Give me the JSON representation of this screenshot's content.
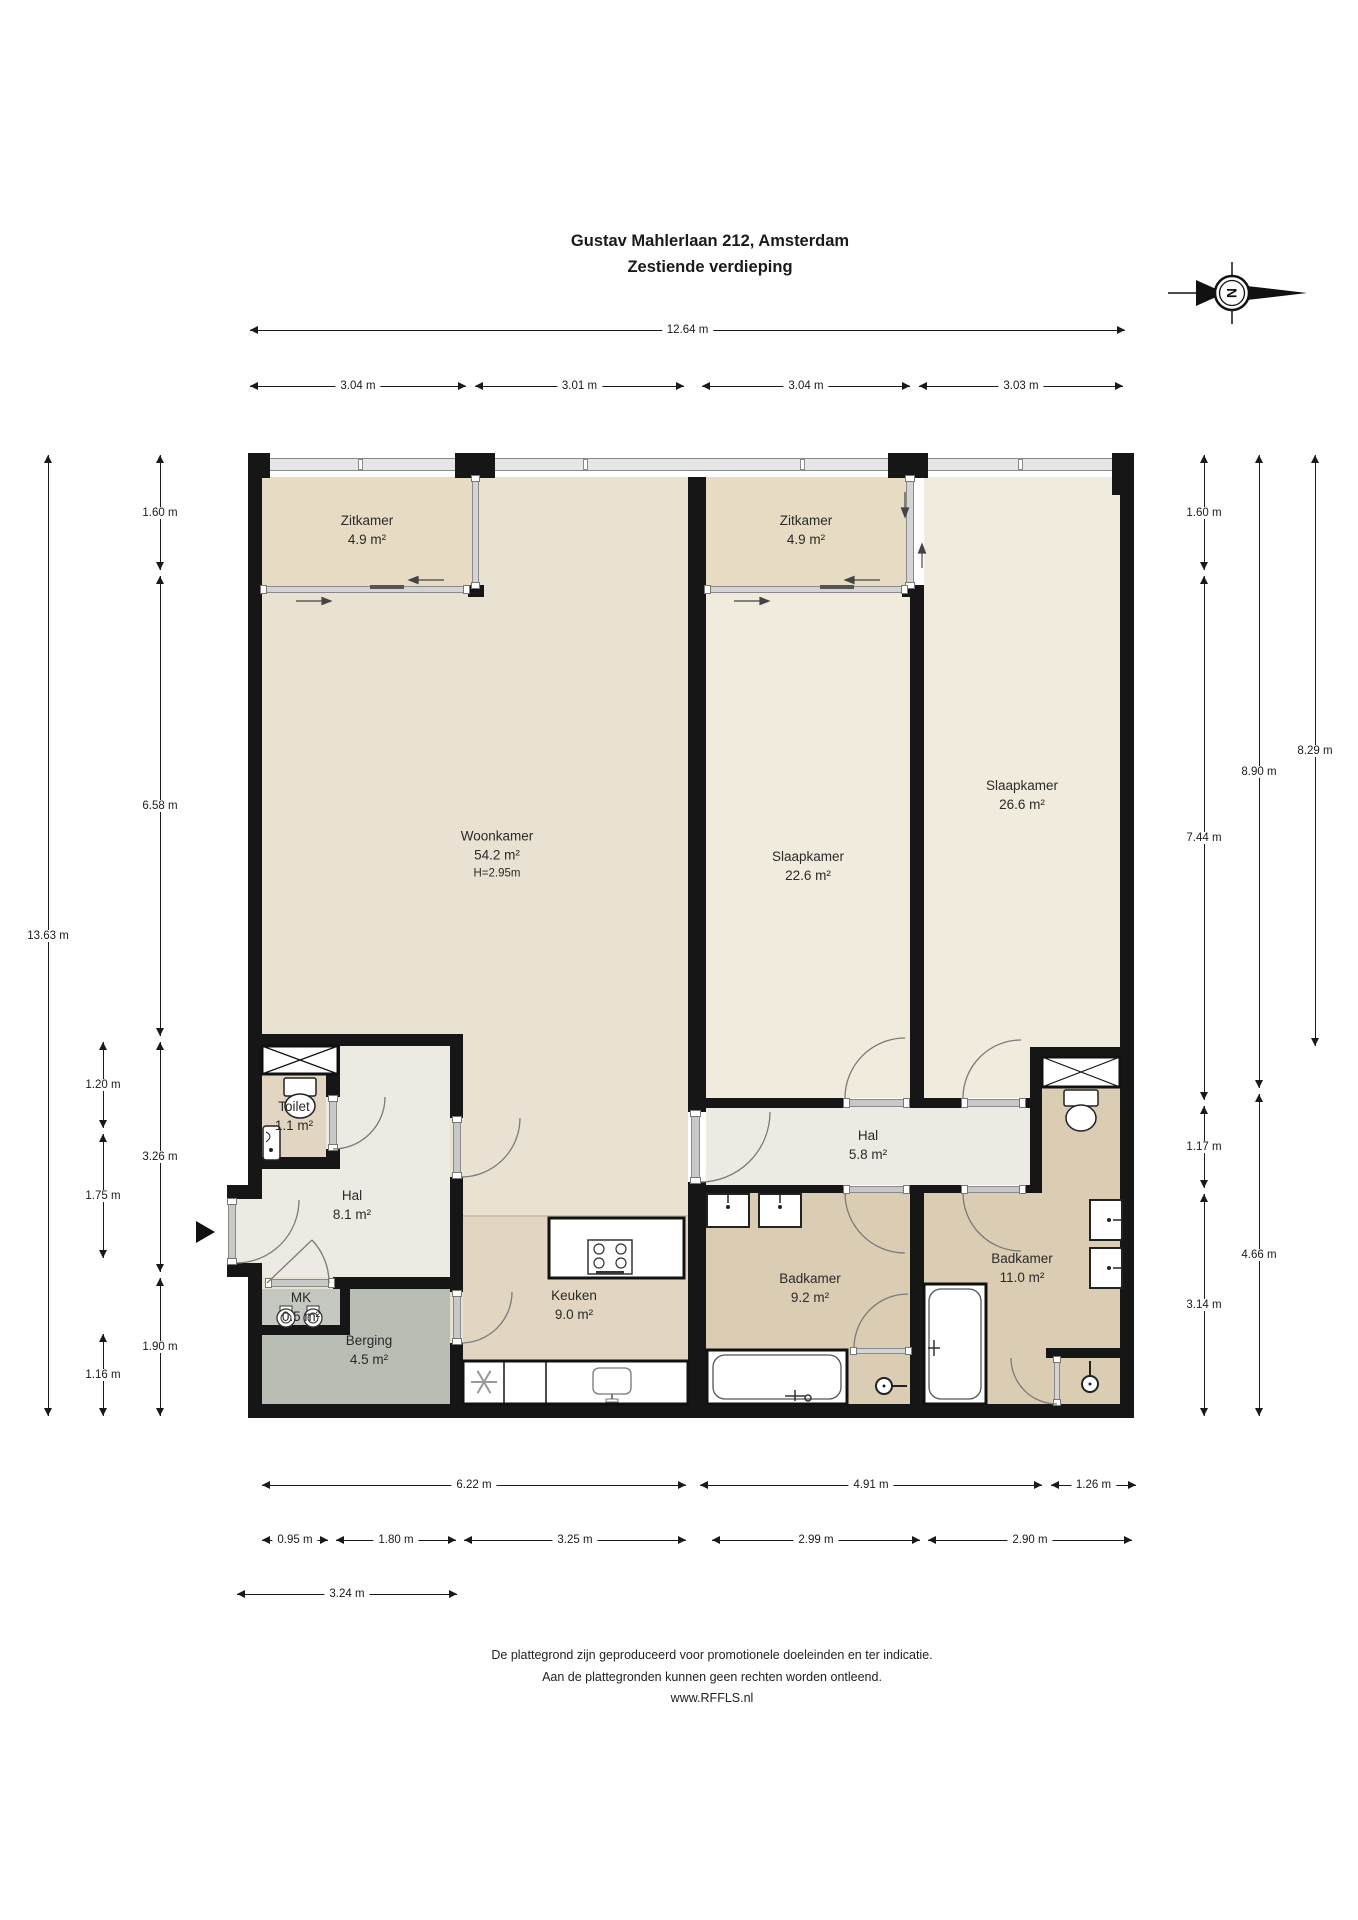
{
  "title": {
    "line1": "Gustav Mahlerlaan 212, Amsterdam",
    "line2": "Zestiende verdieping"
  },
  "compass": {
    "letter": "N"
  },
  "rooms": [
    {
      "id": "zitkamer-links",
      "name": "Zitkamer",
      "area": "4.9 m²"
    },
    {
      "id": "zitkamer-midden",
      "name": "Zitkamer",
      "area": "4.9 m²"
    },
    {
      "id": "woonkamer",
      "name": "Woonkamer",
      "area": "54.2 m²",
      "note": "H=2.95m"
    },
    {
      "id": "slaapkamer-midden",
      "name": "Slaapkamer",
      "area": "22.6 m²"
    },
    {
      "id": "slaapkamer-rechts",
      "name": "Slaapkamer",
      "area": "26.6 m²"
    },
    {
      "id": "toilet",
      "name": "Toilet",
      "area": "1.1 m²"
    },
    {
      "id": "hal",
      "name": "Hal",
      "area": "8.1 m²"
    },
    {
      "id": "hal-2",
      "name": "Hal",
      "area": "5.8 m²"
    },
    {
      "id": "mk",
      "name": "MK",
      "area": "0.5 m²"
    },
    {
      "id": "berging",
      "name": "Berging",
      "area": "4.5 m²"
    },
    {
      "id": "keuken",
      "name": "Keuken",
      "area": "9.0 m²"
    },
    {
      "id": "badkamer-links",
      "name": "Badkamer",
      "area": "9.2 m²"
    },
    {
      "id": "badkamer-rechts",
      "name": "Badkamer",
      "area": "11.0 m²"
    }
  ],
  "dimensions": {
    "top": [
      "12.64 m",
      "3.04 m",
      "3.01 m",
      "3.04 m",
      "3.03 m"
    ],
    "left": [
      "13.63 m",
      "1.60 m",
      "6.58 m",
      "3.26 m",
      "1.90 m",
      "1.20 m",
      "1.75 m",
      "1.16 m"
    ],
    "right": [
      "1.60 m",
      "7.44 m",
      "1.17 m",
      "3.14 m",
      "8.90 m",
      "4.66 m",
      "8.29 m"
    ],
    "bottom": [
      "6.22 m",
      "4.91 m",
      "1.26 m",
      "0.95 m",
      "1.80 m",
      "3.25 m",
      "2.99 m",
      "2.90 m",
      "3.24 m"
    ]
  },
  "footer": {
    "line1": "De plattegrond zijn geproduceerd voor promotionele doeleinden en ter indicatie.",
    "line2": "Aan de plattegronden kunnen geen rechten worden ontleend.",
    "line3": "www.RFFLS.nl"
  },
  "colors": {
    "wall": "#161616",
    "zitkamer": "#e7dbc4",
    "woonkamer": "#e9e1d1",
    "slaapkamer": "#f1ebde",
    "hal": "#edeae3",
    "keuken": "#e2d6c3",
    "toilet": "#e2d6c3",
    "badkamer": "#dbcdb4",
    "berging": "#b9beb5",
    "mk": "#c5c8c0",
    "window": "#e6e6e6",
    "door_band": "#c8c8c8"
  }
}
